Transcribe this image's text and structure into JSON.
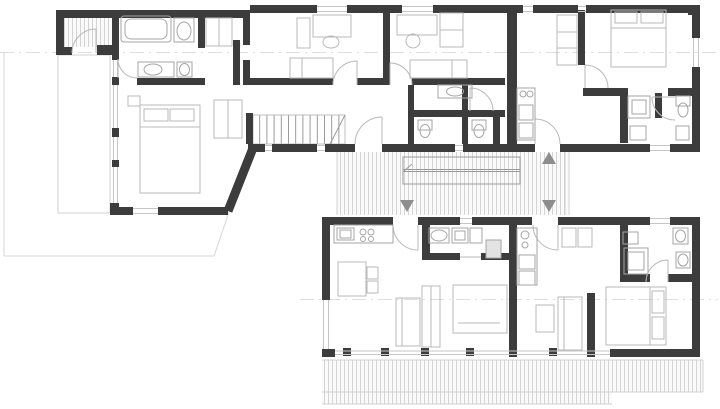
{
  "meta": {
    "kind": "architectural-floor-plan",
    "description": "black-wall line drawing of a two-wing house connected by a hatched deck walkway with an external stair; no text labels are rendered in the drawing"
  },
  "palette": {
    "bg": "#ffffff",
    "wall": "#3c3c3c",
    "furniture": "#b8b8b8",
    "fixture": "#a6a6a6",
    "window": "#c6c6c6",
    "deck_line": "#d0d0d0",
    "deck_fill": "#fafafa",
    "stair_line": "#9a9a9a",
    "site": "#d6d6d6",
    "marker": "#8d8d8d",
    "section": "#dedede"
  },
  "plan": {
    "buildings": [
      {
        "id": "north-wing",
        "rooms": [
          "entry-porch",
          "bathroom-north",
          "master-bedroom",
          "bedroom-1",
          "bedroom-2",
          "hallway",
          "sanitary-block",
          "interior-stair",
          "entry-hall-east",
          "bedroom-3",
          "bathroom-east"
        ]
      },
      {
        "id": "south-wing",
        "rooms": [
          "kitchen-living-west",
          "bathroom-west",
          "kitchen-living-east",
          "bathroom-east",
          "bedroom-south"
        ]
      }
    ],
    "outdoor": [
      "west-terrace",
      "central-deck-walkway",
      "deck-stair",
      "south-terrace",
      "site-boundary"
    ],
    "markers": [
      {
        "type": "entrance-arrow",
        "direction": "up"
      },
      {
        "type": "entrance-arrow",
        "direction": "down"
      },
      {
        "type": "entrance-arrow",
        "direction": "down"
      }
    ],
    "section_lines": 2
  }
}
